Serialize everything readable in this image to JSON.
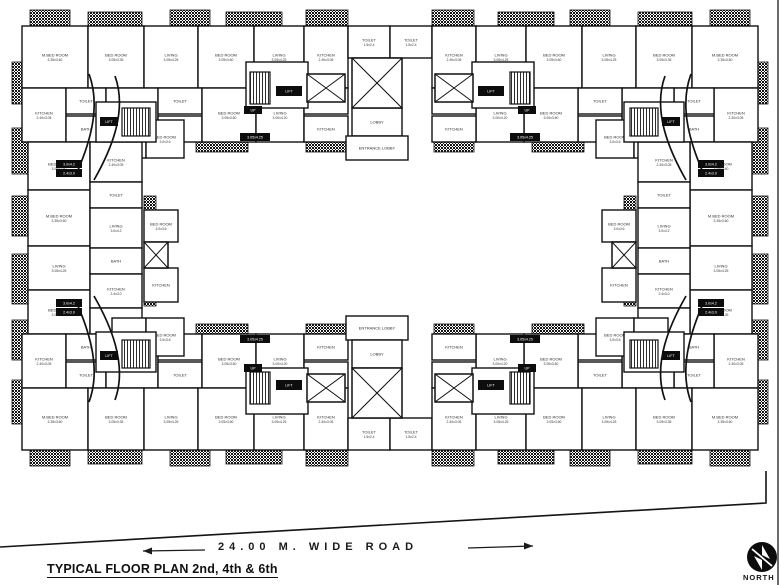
{
  "labels": {
    "title": "TYPICAL FLOOR PLAN 2nd, 4th & 6th",
    "road": "24.00 M. WIDE ROAD",
    "north": "NORTH"
  },
  "plan": {
    "wall_color": "#111111",
    "hatches": [
      [
        30,
        10,
        40,
        16
      ],
      [
        88,
        12,
        54,
        16
      ],
      [
        170,
        10,
        40,
        16
      ],
      [
        226,
        12,
        56,
        16
      ],
      [
        306,
        10,
        42,
        16
      ],
      [
        432,
        10,
        42,
        16
      ],
      [
        498,
        12,
        56,
        16
      ],
      [
        570,
        10,
        40,
        16
      ],
      [
        638,
        12,
        54,
        16
      ],
      [
        710,
        10,
        40,
        16
      ],
      [
        30,
        450,
        40,
        16
      ],
      [
        88,
        448,
        54,
        16
      ],
      [
        170,
        450,
        40,
        16
      ],
      [
        226,
        448,
        56,
        16
      ],
      [
        306,
        450,
        42,
        16
      ],
      [
        432,
        450,
        42,
        16
      ],
      [
        498,
        448,
        56,
        16
      ],
      [
        570,
        450,
        40,
        16
      ],
      [
        638,
        448,
        54,
        16
      ],
      [
        710,
        450,
        40,
        16
      ],
      [
        12,
        62,
        16,
        42
      ],
      [
        12,
        128,
        16,
        46
      ],
      [
        12,
        196,
        16,
        40
      ],
      [
        12,
        254,
        16,
        50
      ],
      [
        12,
        320,
        16,
        40
      ],
      [
        12,
        380,
        16,
        44
      ],
      [
        752,
        62,
        16,
        42
      ],
      [
        752,
        128,
        16,
        46
      ],
      [
        752,
        196,
        16,
        40
      ],
      [
        752,
        254,
        16,
        50
      ],
      [
        752,
        320,
        16,
        40
      ],
      [
        752,
        380,
        16,
        44
      ],
      [
        60,
        140,
        52,
        12
      ],
      [
        196,
        140,
        52,
        12
      ],
      [
        306,
        140,
        40,
        12
      ],
      [
        434,
        140,
        40,
        12
      ],
      [
        532,
        140,
        52,
        12
      ],
      [
        668,
        140,
        52,
        12
      ],
      [
        60,
        324,
        52,
        12
      ],
      [
        196,
        324,
        52,
        12
      ],
      [
        306,
        324,
        40,
        12
      ],
      [
        434,
        324,
        40,
        12
      ],
      [
        532,
        324,
        52,
        12
      ],
      [
        668,
        324,
        52,
        12
      ],
      [
        144,
        196,
        12,
        40
      ],
      [
        144,
        262,
        12,
        44
      ],
      [
        624,
        196,
        12,
        40
      ],
      [
        624,
        262,
        12,
        44
      ],
      [
        214,
        60,
        16,
        34
      ],
      [
        550,
        60,
        16,
        34
      ],
      [
        214,
        382,
        16,
        34
      ],
      [
        550,
        382,
        16,
        34
      ]
    ],
    "rooms": [
      [
        22,
        26,
        66,
        62,
        "M.BED ROOM",
        "3.35x3.60"
      ],
      [
        88,
        26,
        56,
        62,
        "BED ROOM",
        "3.05x3.35"
      ],
      [
        144,
        26,
        54,
        62,
        "LIVING",
        "3.05x4.25"
      ],
      [
        198,
        26,
        56,
        62,
        "BED ROOM",
        "3.05x3.60"
      ],
      [
        254,
        26,
        50,
        62,
        "LIVING",
        "3.05x4.25"
      ],
      [
        304,
        26,
        44,
        62,
        "KITCHEN",
        "2.40x3.05"
      ],
      [
        348,
        26,
        42,
        32,
        "TOILET",
        "1.5x2.4"
      ],
      [
        390,
        26,
        42,
        32,
        "TOILET",
        "1.5x2.4"
      ],
      [
        432,
        26,
        44,
        62,
        "KITCHEN",
        "2.40x3.05"
      ],
      [
        476,
        26,
        50,
        62,
        "LIVING",
        "3.05x4.25"
      ],
      [
        526,
        26,
        56,
        62,
        "BED ROOM",
        "3.05x3.60"
      ],
      [
        582,
        26,
        54,
        62,
        "LIVING",
        "3.05x4.25"
      ],
      [
        636,
        26,
        56,
        62,
        "BED ROOM",
        "3.05x3.35"
      ],
      [
        692,
        26,
        66,
        62,
        "M.BED ROOM",
        "3.35x3.60"
      ],
      [
        22,
        88,
        44,
        54,
        "KITCHEN",
        "2.40x3.05"
      ],
      [
        66,
        88,
        40,
        26,
        "TOILET",
        ""
      ],
      [
        66,
        116,
        40,
        26,
        "BATH",
        ""
      ],
      [
        106,
        88,
        52,
        54,
        "LIVING",
        "3.05x4.25"
      ],
      [
        158,
        88,
        44,
        26,
        "TOILET",
        ""
      ],
      [
        158,
        116,
        44,
        26,
        "W.C.",
        ""
      ],
      [
        202,
        88,
        54,
        54,
        "BED ROOM",
        "3.05x3.60"
      ],
      [
        256,
        88,
        48,
        54,
        "LIVING",
        "3.00x4.20"
      ],
      [
        304,
        88,
        44,
        26,
        "PASS",
        ""
      ],
      [
        304,
        116,
        44,
        26,
        "KITCHEN",
        ""
      ],
      [
        714,
        88,
        44,
        54,
        "KITCHEN",
        "2.40x3.05"
      ],
      [
        674,
        88,
        40,
        26,
        "TOILET",
        ""
      ],
      [
        674,
        116,
        40,
        26,
        "BATH",
        ""
      ],
      [
        622,
        88,
        52,
        54,
        "LIVING",
        "3.05x4.25"
      ],
      [
        578,
        88,
        44,
        26,
        "TOILET",
        ""
      ],
      [
        578,
        116,
        44,
        26,
        "W.C.",
        ""
      ],
      [
        524,
        88,
        54,
        54,
        "BED ROOM",
        "3.05x3.60"
      ],
      [
        476,
        88,
        48,
        54,
        "LIVING",
        "3.00x4.20"
      ],
      [
        432,
        88,
        44,
        26,
        "PASS",
        ""
      ],
      [
        432,
        116,
        44,
        26,
        "KITCHEN",
        ""
      ],
      [
        112,
        120,
        34,
        38,
        "KITCHEN",
        "2.4x3.0"
      ],
      [
        146,
        120,
        38,
        38,
        "BED ROOM",
        "3.0x3.6"
      ],
      [
        596,
        120,
        38,
        38,
        "BED ROOM",
        "3.0x3.6"
      ],
      [
        634,
        120,
        34,
        38,
        "KITCHEN",
        "2.4x3.0"
      ],
      [
        352,
        108,
        50,
        28,
        "LOBBY",
        ""
      ],
      [
        346,
        136,
        62,
        24,
        "ENTRANCE LOBBY",
        ""
      ],
      [
        28,
        142,
        62,
        48,
        "BED ROOM",
        "3.05x3.60"
      ],
      [
        28,
        190,
        62,
        56,
        "M.BED ROOM",
        "3.35x3.60"
      ],
      [
        28,
        246,
        62,
        44,
        "LIVING",
        "3.05x4.25"
      ],
      [
        28,
        290,
        62,
        44,
        "BED ROOM",
        "3.05x3.35"
      ],
      [
        90,
        142,
        52,
        40,
        "KITCHEN",
        "2.40x3.05"
      ],
      [
        90,
        182,
        52,
        26,
        "TOILET",
        ""
      ],
      [
        90,
        208,
        52,
        40,
        "LIVING",
        "3.0x4.2"
      ],
      [
        90,
        248,
        52,
        26,
        "BATH",
        ""
      ],
      [
        90,
        274,
        52,
        34,
        "KITCHEN",
        "2.4x3.0"
      ],
      [
        90,
        308,
        52,
        26,
        "W.C.",
        ""
      ],
      [
        144,
        210,
        34,
        32,
        "BED ROOM",
        "3.0x3.6"
      ],
      [
        144,
        268,
        34,
        34,
        "KITCHEN",
        ""
      ],
      [
        690,
        142,
        62,
        48,
        "BED ROOM",
        "3.05x3.60"
      ],
      [
        690,
        190,
        62,
        56,
        "M.BED ROOM",
        "3.35x3.60"
      ],
      [
        690,
        246,
        62,
        44,
        "LIVING",
        "3.05x4.25"
      ],
      [
        690,
        290,
        62,
        44,
        "BED ROOM",
        "3.05x3.35"
      ],
      [
        638,
        142,
        52,
        40,
        "KITCHEN",
        "2.40x3.05"
      ],
      [
        638,
        182,
        52,
        26,
        "TOILET",
        ""
      ],
      [
        638,
        208,
        52,
        40,
        "LIVING",
        "3.0x4.2"
      ],
      [
        638,
        248,
        52,
        26,
        "BATH",
        ""
      ],
      [
        638,
        274,
        52,
        34,
        "KITCHEN",
        "2.4x3.0"
      ],
      [
        638,
        308,
        52,
        26,
        "W.C.",
        ""
      ],
      [
        602,
        210,
        34,
        32,
        "BED ROOM",
        "3.0x3.6"
      ],
      [
        602,
        268,
        34,
        34,
        "KITCHEN",
        ""
      ],
      [
        22,
        334,
        44,
        54,
        "KITCHEN",
        "2.40x3.05"
      ],
      [
        66,
        334,
        40,
        26,
        "BATH",
        ""
      ],
      [
        66,
        362,
        40,
        26,
        "TOILET",
        ""
      ],
      [
        106,
        334,
        52,
        54,
        "LIVING",
        "3.05x4.25"
      ],
      [
        158,
        334,
        44,
        26,
        "W.C.",
        ""
      ],
      [
        158,
        362,
        44,
        26,
        "TOILET",
        ""
      ],
      [
        202,
        334,
        54,
        54,
        "BED ROOM",
        "3.05x3.60"
      ],
      [
        256,
        334,
        48,
        54,
        "LIVING",
        "3.00x4.20"
      ],
      [
        304,
        334,
        44,
        26,
        "KITCHEN",
        ""
      ],
      [
        304,
        362,
        44,
        26,
        "PASS",
        ""
      ],
      [
        714,
        334,
        44,
        54,
        "KITCHEN",
        "2.40x3.05"
      ],
      [
        674,
        334,
        40,
        26,
        "BATH",
        ""
      ],
      [
        674,
        362,
        40,
        26,
        "TOILET",
        ""
      ],
      [
        622,
        334,
        52,
        54,
        "LIVING",
        "3.05x4.25"
      ],
      [
        578,
        334,
        44,
        26,
        "W.C.",
        ""
      ],
      [
        578,
        362,
        44,
        26,
        "TOILET",
        ""
      ],
      [
        524,
        334,
        54,
        54,
        "BED ROOM",
        "3.05x3.60"
      ],
      [
        476,
        334,
        48,
        54,
        "LIVING",
        "3.00x4.20"
      ],
      [
        432,
        334,
        44,
        26,
        "KITCHEN",
        ""
      ],
      [
        432,
        362,
        44,
        26,
        "PASS",
        ""
      ],
      [
        112,
        318,
        34,
        38,
        "KITCHEN",
        "2.4x3.0"
      ],
      [
        146,
        318,
        38,
        38,
        "BED ROOM",
        "3.0x3.6"
      ],
      [
        596,
        318,
        38,
        38,
        "BED ROOM",
        "3.0x3.6"
      ],
      [
        634,
        318,
        34,
        38,
        "KITCHEN",
        "2.4x3.0"
      ],
      [
        346,
        316,
        62,
        24,
        "ENTRANCE LOBBY",
        ""
      ],
      [
        352,
        340,
        50,
        28,
        "LOBBY",
        ""
      ],
      [
        22,
        388,
        66,
        62,
        "M.BED ROOM",
        "3.35x3.60"
      ],
      [
        88,
        388,
        56,
        62,
        "BED ROOM",
        "3.05x3.35"
      ],
      [
        144,
        388,
        54,
        62,
        "LIVING",
        "3.05x4.25"
      ],
      [
        198,
        388,
        56,
        62,
        "BED ROOM",
        "3.05x3.60"
      ],
      [
        254,
        388,
        50,
        62,
        "LIVING",
        "3.05x4.25"
      ],
      [
        304,
        388,
        44,
        62,
        "KITCHEN",
        "2.40x3.05"
      ],
      [
        348,
        418,
        42,
        32,
        "TOILET",
        "1.5x2.4"
      ],
      [
        390,
        418,
        42,
        32,
        "TOILET",
        "1.5x2.4"
      ],
      [
        432,
        388,
        44,
        62,
        "KITCHEN",
        "2.40x3.05"
      ],
      [
        476,
        388,
        50,
        62,
        "LIVING",
        "3.05x4.25"
      ],
      [
        526,
        388,
        56,
        62,
        "BED ROOM",
        "3.05x3.60"
      ],
      [
        582,
        388,
        54,
        62,
        "LIVING",
        "3.05x4.25"
      ],
      [
        636,
        388,
        56,
        62,
        "BED ROOM",
        "3.05x3.35"
      ],
      [
        692,
        388,
        66,
        62,
        "M.BED ROOM",
        "3.35x3.60"
      ]
    ],
    "whiteboxes": [
      [
        96,
        102,
        60,
        40
      ],
      [
        624,
        102,
        60,
        40
      ],
      [
        96,
        332,
        60,
        40
      ],
      [
        624,
        332,
        60,
        40
      ],
      [
        246,
        62,
        62,
        46
      ],
      [
        472,
        62,
        62,
        46
      ],
      [
        246,
        368,
        62,
        46
      ],
      [
        472,
        368,
        62,
        46
      ]
    ],
    "stairs": [
      [
        250,
        72,
        20,
        32
      ],
      [
        510,
        72,
        20,
        32
      ],
      [
        250,
        372,
        20,
        32
      ],
      [
        510,
        372,
        20,
        32
      ],
      [
        122,
        108,
        28,
        28
      ],
      [
        630,
        108,
        28,
        28
      ],
      [
        122,
        340,
        28,
        28
      ],
      [
        630,
        340,
        28,
        28
      ]
    ],
    "xboxes": [
      [
        352,
        58,
        50,
        50
      ],
      [
        307,
        74,
        38,
        28
      ],
      [
        435,
        74,
        38,
        28
      ],
      [
        352,
        368,
        50,
        50
      ],
      [
        307,
        374,
        38,
        28
      ],
      [
        435,
        374,
        38,
        28
      ],
      [
        144,
        242,
        24,
        26
      ],
      [
        612,
        242,
        24,
        26
      ]
    ],
    "arcs": [
      "M89,74 C101,106 90,142 78,170",
      "M115,76 C128,112 110,152 94,180",
      "M691,74 C679,106 690,142 702,170",
      "M665,76 C652,112 670,152 686,180",
      "M89,402 C101,370 90,334 78,306",
      "M115,400 C128,364 110,324 94,296",
      "M691,402 C679,370 690,334 702,306",
      "M665,400 C652,364 670,324 686,296"
    ],
    "tags": [
      [
        100,
        117,
        18,
        9,
        "LIFT"
      ],
      [
        662,
        117,
        18,
        9,
        "LIFT"
      ],
      [
        100,
        351,
        18,
        9,
        "LIFT"
      ],
      [
        662,
        351,
        18,
        9,
        "LIFT"
      ],
      [
        276,
        86,
        26,
        10,
        "LIFT"
      ],
      [
        478,
        86,
        26,
        10,
        "LIFT"
      ],
      [
        276,
        380,
        26,
        10,
        "LIFT"
      ],
      [
        478,
        380,
        26,
        10,
        "LIFT"
      ],
      [
        56,
        160,
        26,
        8,
        "3.0x4.2"
      ],
      [
        56,
        169,
        26,
        8,
        "2.4x3.0"
      ],
      [
        698,
        160,
        26,
        8,
        "3.0x4.2"
      ],
      [
        698,
        169,
        26,
        8,
        "2.4x3.0"
      ],
      [
        56,
        299,
        26,
        8,
        "3.0x4.2"
      ],
      [
        56,
        308,
        26,
        8,
        "2.4x3.0"
      ],
      [
        698,
        299,
        26,
        8,
        "3.0x4.2"
      ],
      [
        698,
        308,
        26,
        8,
        "2.4x3.0"
      ],
      [
        240,
        133,
        30,
        8,
        "3.05x4.25"
      ],
      [
        510,
        133,
        30,
        8,
        "3.05x4.25"
      ],
      [
        240,
        335,
        30,
        8,
        "3.05x4.25"
      ],
      [
        510,
        335,
        30,
        8,
        "3.05x4.25"
      ],
      [
        244,
        106,
        18,
        8,
        "UP"
      ],
      [
        518,
        106,
        18,
        8,
        "UP"
      ],
      [
        244,
        364,
        18,
        8,
        "UP"
      ],
      [
        518,
        364,
        18,
        8,
        "UP"
      ]
    ],
    "boundary": {
      "points": "0,547 766,503 766,471",
      "edge": [
        778,
        0,
        778,
        585
      ]
    },
    "road_arrows": {
      "left": {
        "x1": 205,
        "y1": 550,
        "x2": 143,
        "y2": 551
      },
      "right": {
        "x1": 468,
        "y1": 548,
        "x2": 533,
        "y2": 546
      }
    },
    "compass": {
      "cx": 762,
      "cy": 557,
      "r": 15
    }
  }
}
